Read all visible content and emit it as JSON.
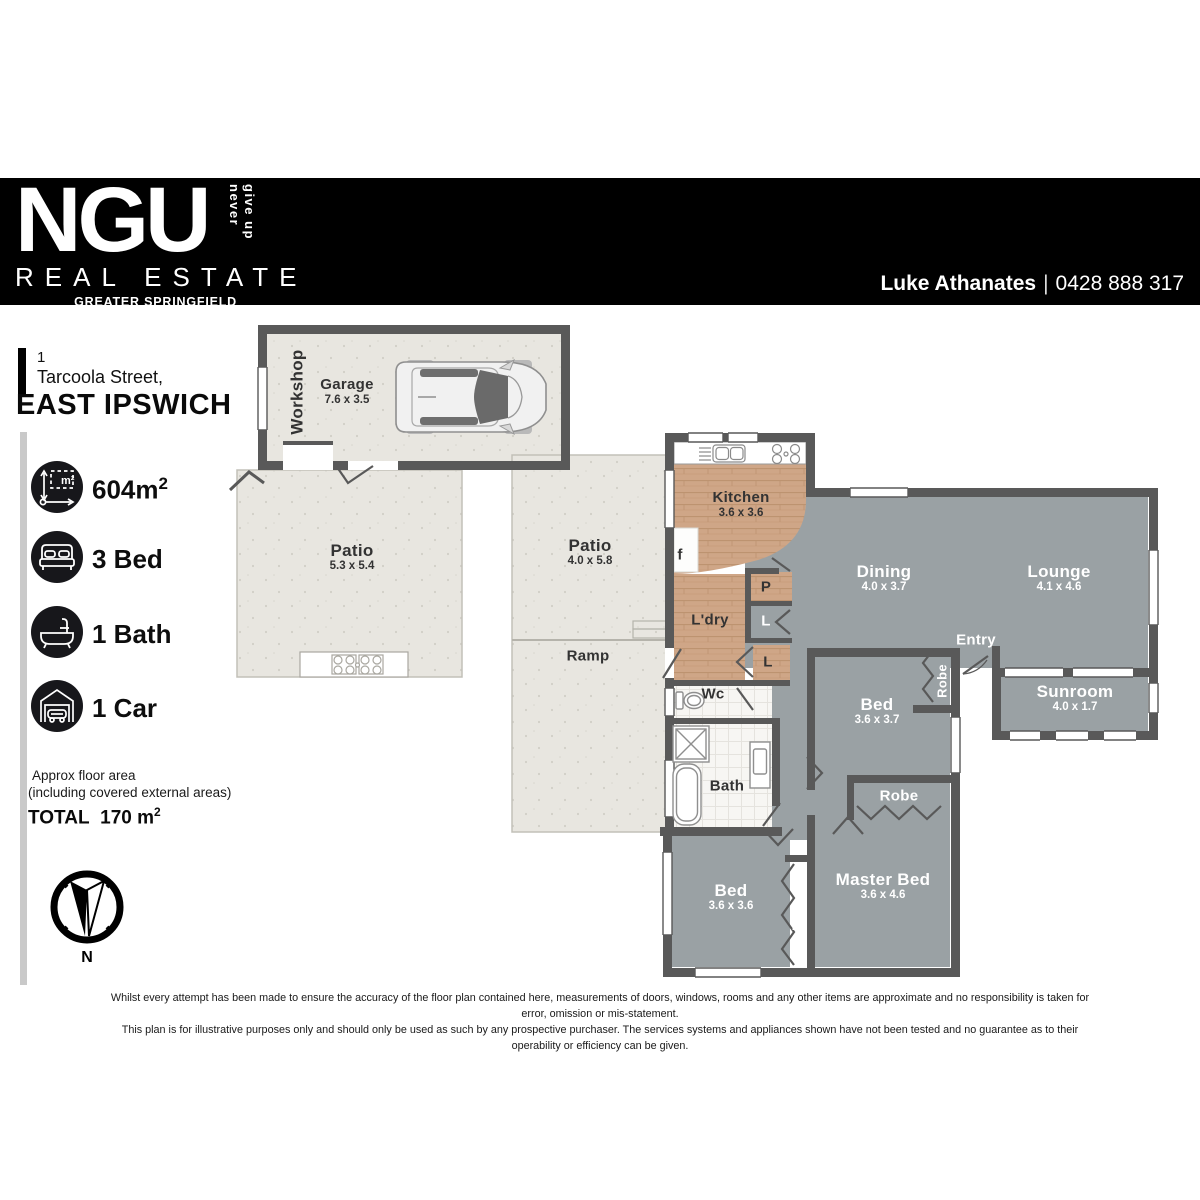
{
  "header": {
    "brand": "NGU",
    "tagline": "never give up",
    "division": "REAL ESTATE",
    "region": "GREATER SPRINGFIELD",
    "agent_name": "Luke Athanates",
    "agent_separator": "|",
    "agent_phone": "0428 888 317"
  },
  "address": {
    "number": "1",
    "street": "Tarcoola Street,",
    "suburb": "EAST IPSWICH"
  },
  "stats": {
    "land_value": "604m",
    "land_sup": "2",
    "beds": "3 Bed",
    "baths": "1 Bath",
    "cars": "1 Car"
  },
  "floor_area": {
    "note_line1": "Approx floor area",
    "note_line2": "(including covered external areas)",
    "total_label": "TOTAL",
    "total_value": "170 m",
    "total_sup": "2"
  },
  "compass": {
    "north": "N"
  },
  "rooms": {
    "workshop": {
      "name": "Workshop"
    },
    "garage": {
      "name": "Garage",
      "dims": "7.6 x 3.5"
    },
    "patio1": {
      "name": "Patio",
      "dims": "5.3 x 5.4"
    },
    "patio2": {
      "name": "Patio",
      "dims": "4.0 x 5.8"
    },
    "ramp": {
      "name": "Ramp"
    },
    "kitchen": {
      "name": "Kitchen",
      "dims": "3.6 x 3.6"
    },
    "fridge": {
      "name": "f"
    },
    "laundry": {
      "name": "L'dry"
    },
    "pantry": {
      "name": "P"
    },
    "linen1": {
      "name": "L"
    },
    "linen2": {
      "name": "L"
    },
    "wc": {
      "name": "Wc"
    },
    "bath": {
      "name": "Bath"
    },
    "dining": {
      "name": "Dining",
      "dims": "4.0 x 3.7"
    },
    "lounge": {
      "name": "Lounge",
      "dims": "4.1 x 4.6"
    },
    "entry": {
      "name": "Entry"
    },
    "sunroom": {
      "name": "Sunroom",
      "dims": "4.0 x 1.7"
    },
    "bed1": {
      "name": "Bed",
      "dims": "3.6 x 3.7"
    },
    "robe1": {
      "name": "Robe"
    },
    "robe2": {
      "name": "Robe"
    },
    "bed2": {
      "name": "Bed",
      "dims": "3.6 x 3.6"
    },
    "robe3": {
      "name": "Robe"
    },
    "master": {
      "name": "Master Bed",
      "dims": "3.6 x 4.6"
    }
  },
  "disclaimer": {
    "line1": "Whilst every attempt has been made to ensure the accuracy of the floor plan contained here, measurements of doors, windows, rooms and any other items are approximate and no responsibility is taken for error, omission or mis-statement.",
    "line2": "This plan is for illustrative purposes only and should only be used as such by any prospective purchaser. The services systems and appliances shown have not been tested and no guarantee as to their operability or efficiency can be given."
  },
  "colors": {
    "wall": "#595959",
    "interior_floor": "#9aa1a4",
    "outdoor_floor": "#e8e6e0",
    "wood_floor": "#cfa687",
    "header_bg": "#000000"
  }
}
